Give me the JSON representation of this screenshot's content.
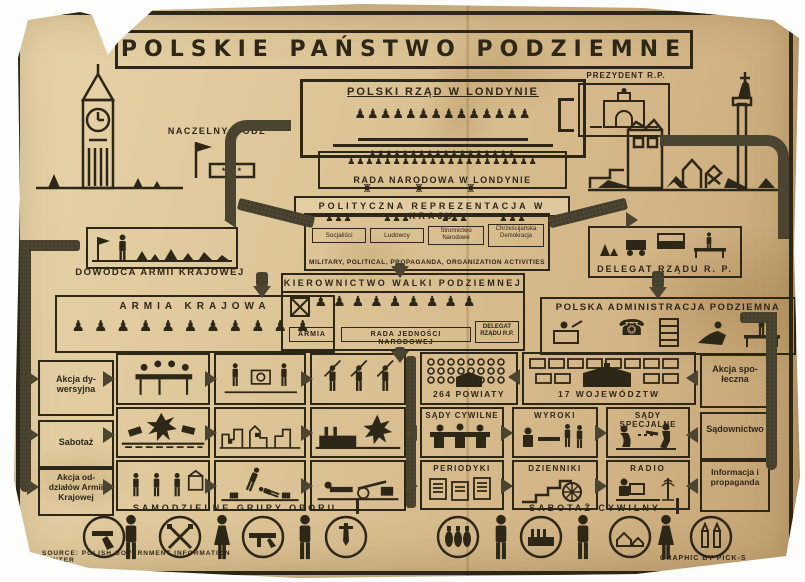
{
  "poster": {
    "title": "POLSKIE PAŃSTWO PODZIEMNE",
    "credits": {
      "source": "SOURCE: POLISH GOVERNMENT INFORMATION CENTER",
      "graphic": "GRAPHIC BY PICK-S"
    },
    "colors": {
      "paper": "#dcc496",
      "ink": "#2d2718",
      "arrow_band": "#4b4431"
    }
  },
  "london": {
    "government": "POLSKI RZĄD W LONDYNIE",
    "president": "PREZYDENT R.P.",
    "commander_in_chief": "NACZELNY WÓDZ",
    "commander_stars": "★ ★ ★",
    "national_council": "RADA NARODOWA W LONDYNIE"
  },
  "homeland": {
    "political_representation": "POLITYCZNA REPREZENTACJA W KRAJU",
    "parties": [
      "Socjaliści",
      "Ludowcy",
      "Stronnictwo Narodowe",
      "Chrześcijańska Demokracja"
    ],
    "parties_caption": "MILITARY, POLITICAL, PROPAGANDA, ORGANIZATION ACTIVITIES",
    "ak_commander": "DOWÓDCA ARMII KRAJOWEJ",
    "government_delegate": "DELEGAT RZĄDU R. P.",
    "home_army": "ARMIA KRAJOWA",
    "directorate": "KIEROWNICTWO WALKI PODZIEMNEJ",
    "kwp_army": "ARMIA",
    "kwp_council": "RADA JEDNOŚCI NARODOWEJ",
    "kwp_delegate": "DELEGAT RZĄDU R.P.",
    "administration": "POLSKA ADMINISTRACJA PODZIEMNA"
  },
  "columns": {
    "left": [
      "Akcja dy­wersyjna",
      "Sabotaż",
      "Akcja od­działów Armii Krajowej"
    ],
    "right": [
      "Akcja spo­łeczna",
      "Sądow­nictwo",
      "Informa­cja i pro­paganda"
    ]
  },
  "admin_units": {
    "counties": "264 POWIATY",
    "voivodeships": "17 WOJEWÓDZTW"
  },
  "justice": {
    "civil_courts": "SĄDY CYWILNE",
    "verdicts": "WYROKI",
    "special_courts": "SĄDY SPECJALNE"
  },
  "press": {
    "periodicals": "PERIODYKI",
    "dailies": "DZIENNIKI",
    "radio": "RADIO"
  },
  "bottom": {
    "resistance_caption": "SAMODZIELNE GRUPY OPORU",
    "sabotage_caption": "SABOTAŻ CYWILNY"
  },
  "figures": {
    "government_row": {
      "glyph": "♟",
      "count": 14
    },
    "council_row1": {
      "glyph": "♟",
      "count": 18
    },
    "council_row2": {
      "glyph": "♟",
      "count": 21
    },
    "statues_row": {
      "glyph": "♜",
      "count": 3
    },
    "party_group": {
      "glyph": "♟",
      "count": 3
    },
    "kwp_row": {
      "glyph": "♟",
      "count": 9
    },
    "ak_row": {
      "glyph": "♟",
      "count": 11
    },
    "admin_phone": {
      "glyph": "☎",
      "count": 1
    }
  },
  "icons": {
    "bottom_row": [
      "pistol",
      "civilian-man",
      "crossed-rifles",
      "civilian-woman",
      "submachine-gun",
      "civilian-man",
      "dagger",
      "hand-grenades",
      "worker",
      "factory",
      "farmer",
      "houses",
      "civilian-woman",
      "rifle-cartridges"
    ]
  }
}
